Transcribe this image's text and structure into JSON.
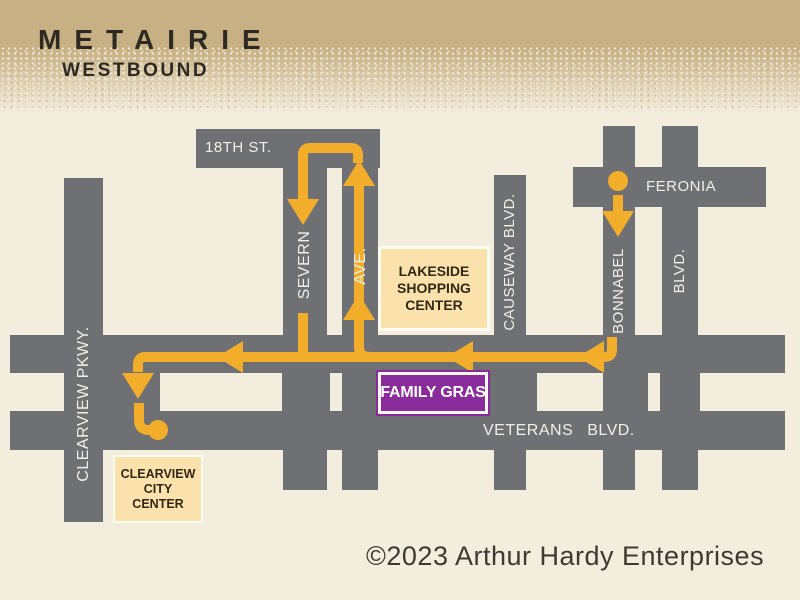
{
  "header": {
    "title": "METAIRIE",
    "subtitle": "WESTBOUND"
  },
  "streets": {
    "eighteenth": "18TH ST.",
    "feronia": "FERONIA",
    "severn": "SEVERN",
    "ave": "AVE.",
    "causeway": "CAUSEWAY BLVD.",
    "bonnabel": "BONNABEL",
    "blvd": "BLVD.",
    "clearview": "CLEARVIEW PKWY.",
    "veterans": "VETERANS BLVD."
  },
  "boxes": {
    "lakeside": {
      "lines": [
        "LAKESIDE",
        "SHOPPING",
        "CENTER"
      ]
    },
    "family_gras": {
      "label": "FAMILY GRAS"
    },
    "clearview_city": {
      "lines": [
        "CLEARVIEW",
        "CITY",
        "CENTER"
      ]
    }
  },
  "footer": {
    "copyright": "©2023 Arthur Hardy Enterprises"
  },
  "colors": {
    "banner_tan": "#C7B083",
    "background": "#F3EDDE",
    "road_gray": "#6F7073",
    "route_gold": "#F2AE2B",
    "box_tan": "#FBE2AC",
    "purple": "#8A2B9B",
    "label_white": "#F2EFE6",
    "ink": "#2D2A24"
  }
}
